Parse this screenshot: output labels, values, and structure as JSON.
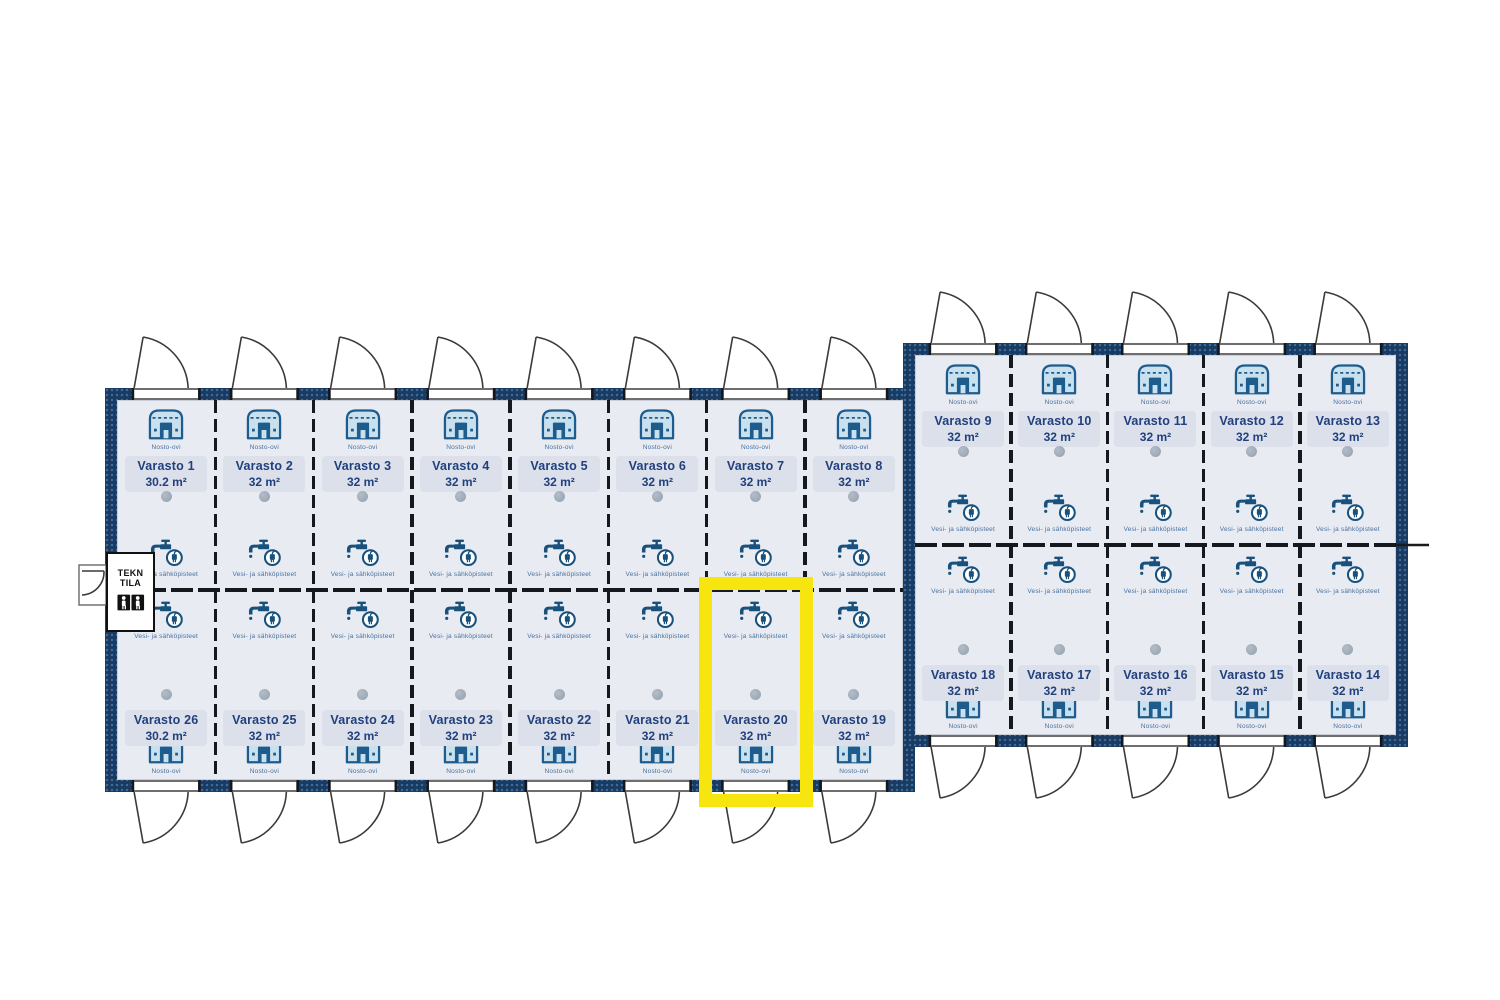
{
  "labels": {
    "door": "Nosto-ovi",
    "utilities": "Vesi- ja sähköpisteet"
  },
  "tech_room": {
    "line1": "TEKN",
    "line2": "TILA"
  },
  "highlight": {
    "unit": "Varasto 20"
  },
  "buildings": {
    "left": {
      "top_row": [
        {
          "name": "Varasto 1",
          "area": "30.2 m²"
        },
        {
          "name": "Varasto 2",
          "area": "32 m²"
        },
        {
          "name": "Varasto 3",
          "area": "32 m²"
        },
        {
          "name": "Varasto 4",
          "area": "32 m²"
        },
        {
          "name": "Varasto 5",
          "area": "32 m²"
        },
        {
          "name": "Varasto 6",
          "area": "32 m²"
        },
        {
          "name": "Varasto 7",
          "area": "32 m²"
        },
        {
          "name": "Varasto 8",
          "area": "32 m²"
        }
      ],
      "bottom_row": [
        {
          "name": "Varasto 26",
          "area": "30.2 m²"
        },
        {
          "name": "Varasto 25",
          "area": "32 m²"
        },
        {
          "name": "Varasto 24",
          "area": "32 m²"
        },
        {
          "name": "Varasto 23",
          "area": "32 m²"
        },
        {
          "name": "Varasto 22",
          "area": "32 m²"
        },
        {
          "name": "Varasto 21",
          "area": "32 m²"
        },
        {
          "name": "Varasto 20",
          "area": "32 m²"
        },
        {
          "name": "Varasto 19",
          "area": "32 m²"
        }
      ]
    },
    "right": {
      "top_row": [
        {
          "name": "Varasto 9",
          "area": "32 m²"
        },
        {
          "name": "Varasto 10",
          "area": "32 m²"
        },
        {
          "name": "Varasto 11",
          "area": "32 m²"
        },
        {
          "name": "Varasto 12",
          "area": "32 m²"
        },
        {
          "name": "Varasto 13",
          "area": "32 m²"
        }
      ],
      "bottom_row": [
        {
          "name": "Varasto 18",
          "area": "32 m²"
        },
        {
          "name": "Varasto 17",
          "area": "32 m²"
        },
        {
          "name": "Varasto 16",
          "area": "32 m²"
        },
        {
          "name": "Varasto 15",
          "area": "32 m²"
        },
        {
          "name": "Varasto 14",
          "area": "32 m²"
        }
      ]
    }
  },
  "colors": {
    "wall": "#1A3A5F",
    "floor": "#E9EBF2",
    "plate": "#DBE0EB",
    "text": "#21407D",
    "icon": "#1D5C8C",
    "highlight_yellow": "#F7E50F",
    "vent": "#93A0AE"
  }
}
